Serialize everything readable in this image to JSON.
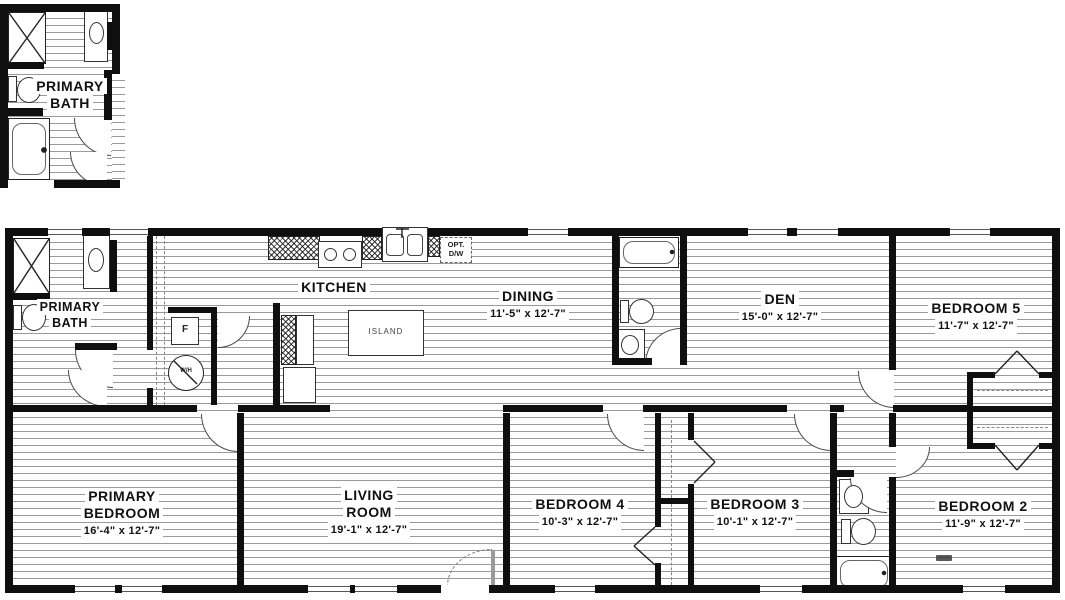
{
  "inset": {
    "line1": "PRIMARY",
    "line2": "BATH"
  },
  "rooms": {
    "primary_bath": {
      "line1": "PRIMARY",
      "line2": "BATH"
    },
    "kitchen": {
      "name": "KITCHEN"
    },
    "dining": {
      "name": "DINING",
      "dims": "11'-5\" x  12'-7\""
    },
    "den": {
      "name": "DEN",
      "dims": "15'-0\" x  12'-7\""
    },
    "bedroom5": {
      "name": "BEDROOM 5",
      "dims": "11'-7\" x  12'-7\""
    },
    "primary_bedroom": {
      "line1": "PRIMARY",
      "line2": "BEDROOM",
      "dims": "16'-4\" x  12'-7\""
    },
    "living_room": {
      "line1": "LIVING",
      "line2": "ROOM",
      "dims": "19'-1\" x  12'-7\""
    },
    "bedroom4": {
      "name": "BEDROOM 4",
      "dims": "10'-3\" x  12'-7\""
    },
    "bedroom3": {
      "name": "BEDROOM 3",
      "dims": "10'-1\" x  12'-7\""
    },
    "bedroom2": {
      "name": "BEDROOM 2",
      "dims": "11'-9\" x  12'-7\""
    }
  },
  "fixtures": {
    "island": "ISLAND",
    "opt_dw_line1": "OPT.",
    "opt_dw_line2": "D/W",
    "furnace": "F",
    "water_heater": "W/H"
  },
  "colors": {
    "wall": "#0f0f0f",
    "hatch_line": "#9a9a9a",
    "text": "#111111"
  }
}
